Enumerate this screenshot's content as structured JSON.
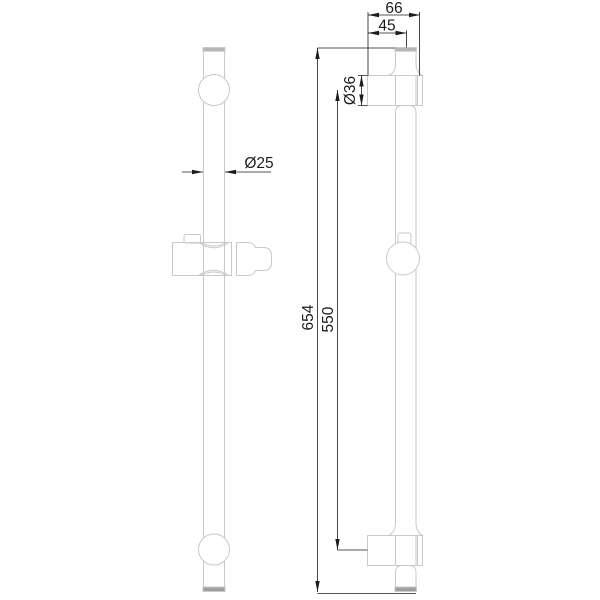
{
  "colors": {
    "object_line": "#c9c9c9",
    "dimension_line": "#1c1c1c",
    "cap_fill": "#b6b6b6",
    "end_cap_fill": "#9f9f9f",
    "background": "#ffffff"
  },
  "dimensions": {
    "depth_overall": "66",
    "depth_to_center": "45",
    "mount_diameter": "Ø36",
    "bar_diameter": "Ø25",
    "overall_length": "654",
    "mount_spacing": "550"
  }
}
